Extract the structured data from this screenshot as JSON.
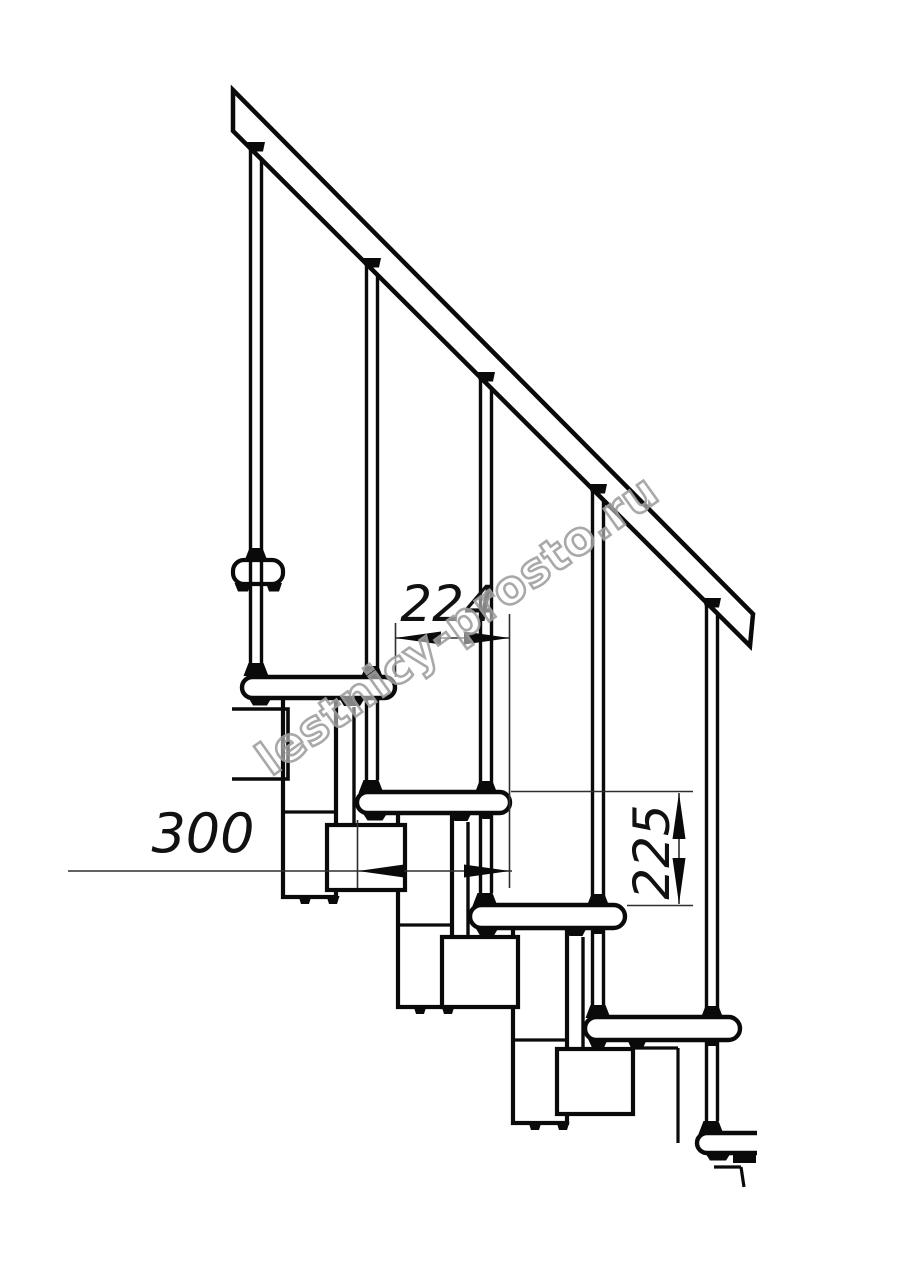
{
  "watermark": {
    "text": "lestnicy-prosto.ru",
    "fill": "#ffffff",
    "outline_color": "#a0a0a0",
    "angle_deg": -35.5,
    "font_size": 46
  },
  "dimensions": {
    "going": {
      "label": "224"
    },
    "tread_depth": {
      "label": "300"
    },
    "rise": {
      "label": "225"
    }
  },
  "drawing": {
    "line_color": "#0a0a0a",
    "thin_color": "#2e2e2e",
    "bg_color": "#ffffff",
    "stroke": {
      "thick": 4.5,
      "rod": 3.4,
      "mid": 3.2,
      "thin": 1.6
    },
    "rail": {
      "points": [
        [
          233,
          90
        ],
        [
          753,
          614
        ],
        [
          750,
          646
        ],
        [
          233,
          131
        ]
      ]
    },
    "bracket": {
      "x": 233,
      "y": 560,
      "w": 50,
      "h": 24,
      "r": 11
    },
    "landing": {
      "points": [
        [
          232,
          709
        ],
        [
          288,
          709
        ],
        [
          288,
          779
        ],
        [
          232,
          779
        ]
      ]
    },
    "balusters": [
      {
        "cx": 256,
        "top": 151,
        "bottom": 663
      },
      {
        "cx": 372,
        "top": 267,
        "bottom": 780
      },
      {
        "cx": 486,
        "top": 381,
        "bottom": 893
      },
      {
        "cx": 598,
        "top": 493,
        "bottom": 1005
      },
      {
        "cx": 712,
        "top": 607,
        "bottom": 1121
      }
    ],
    "rod_half_gap": 5.5,
    "treads": [
      {
        "x": 242,
        "y": 677,
        "w": 153,
        "h": 21
      },
      {
        "x": 357,
        "y": 792,
        "w": 153,
        "h": 21
      },
      {
        "x": 470,
        "y": 905,
        "w": 155,
        "h": 23
      },
      {
        "x": 585,
        "y": 1017,
        "w": 155,
        "h": 23
      }
    ],
    "cut_step": {
      "x": 697,
      "y": 1133,
      "w": 60,
      "h": 20
    },
    "blocks": [
      {
        "x": 283,
        "y": 697,
        "w": 53,
        "h": 200,
        "joint": 812
      },
      {
        "x": 398,
        "y": 812,
        "w": 54,
        "h": 195,
        "joint": 925
      },
      {
        "x": 513,
        "y": 928,
        "w": 54,
        "h": 195,
        "joint": 1040
      }
    ],
    "squares": [
      {
        "x": 327,
        "y": 825,
        "w": 78,
        "h": 65
      },
      {
        "x": 442,
        "y": 937,
        "w": 76,
        "h": 70
      },
      {
        "x": 557,
        "y": 1049,
        "w": 76,
        "h": 65
      }
    ],
    "extra_lines": [
      [
        354,
        707,
        354,
        825
      ],
      [
        468,
        822,
        468,
        937
      ],
      [
        583,
        937,
        583,
        1049
      ]
    ],
    "cut_lines": [
      [
        633,
        1048,
        678,
        1048
      ],
      [
        678,
        1048,
        678,
        1143
      ],
      [
        714,
        1167,
        741,
        1167
      ],
      [
        741,
        1167,
        744,
        1187
      ]
    ],
    "black_rects": [
      {
        "x": 733,
        "y": 1154,
        "w": 23,
        "h": 9
      }
    ],
    "trapezoids": [
      {
        "cx": 256,
        "y": 142,
        "h": 9.5,
        "wt": 18,
        "wb": 14
      },
      {
        "cx": 372,
        "y": 258,
        "h": 9.5,
        "wt": 18,
        "wb": 14
      },
      {
        "cx": 486,
        "y": 372,
        "h": 9.5,
        "wt": 18,
        "wb": 14
      },
      {
        "cx": 598,
        "y": 484,
        "h": 9.5,
        "wt": 18,
        "wb": 14
      },
      {
        "cx": 712,
        "y": 598,
        "h": 9.5,
        "wt": 18,
        "wb": 14
      },
      {
        "cx": 256,
        "y": 663,
        "h": 13,
        "wt": 15,
        "wb": 25
      },
      {
        "cx": 371,
        "y": 780,
        "h": 13,
        "wt": 15,
        "wb": 25
      },
      {
        "cx": 485,
        "y": 893,
        "h": 13,
        "wt": 15,
        "wb": 25
      },
      {
        "cx": 598,
        "y": 1005,
        "h": 13,
        "wt": 15,
        "wb": 25
      },
      {
        "cx": 711,
        "y": 1121,
        "h": 13,
        "wt": 15,
        "wb": 25
      },
      {
        "cx": 256,
        "y": 548,
        "h": 11.5,
        "wt": 13,
        "wb": 22
      },
      {
        "cx": 372,
        "y": 666,
        "h": 11.5,
        "wt": 13,
        "wb": 22
      },
      {
        "cx": 486,
        "y": 781,
        "h": 11.5,
        "wt": 13,
        "wb": 22
      },
      {
        "cx": 598,
        "y": 894,
        "h": 11.5,
        "wt": 13,
        "wb": 22
      },
      {
        "cx": 712,
        "y": 1006,
        "h": 11.5,
        "wt": 13,
        "wb": 22
      },
      {
        "cx": 243,
        "y": 583,
        "h": 8.5,
        "wt": 17,
        "wb": 10
      },
      {
        "cx": 274,
        "y": 583,
        "h": 8.5,
        "wt": 16,
        "wb": 10
      },
      {
        "cx": 260,
        "y": 697,
        "h": 8.5,
        "wt": 24,
        "wb": 14
      },
      {
        "cx": 352,
        "y": 697,
        "h": 9,
        "wt": 27,
        "wb": 16
      },
      {
        "cx": 375,
        "y": 812,
        "h": 8.5,
        "wt": 26,
        "wb": 15
      },
      {
        "cx": 461,
        "y": 812,
        "h": 9,
        "wt": 22,
        "wb": 13
      },
      {
        "cx": 487,
        "y": 812,
        "h": 7,
        "wt": 14,
        "wb": 9
      },
      {
        "cx": 487,
        "y": 927,
        "h": 8.5,
        "wt": 24,
        "wb": 14
      },
      {
        "cx": 576,
        "y": 927,
        "h": 9,
        "wt": 22,
        "wb": 13
      },
      {
        "cx": 598,
        "y": 927,
        "h": 7,
        "wt": 14,
        "wb": 9
      },
      {
        "cx": 598,
        "y": 1039,
        "h": 8.5,
        "wt": 20,
        "wb": 12
      },
      {
        "cx": 637,
        "y": 1039,
        "h": 9,
        "wt": 20,
        "wb": 12
      },
      {
        "cx": 712,
        "y": 1039,
        "h": 7,
        "wt": 14,
        "wb": 9
      },
      {
        "cx": 718,
        "y": 1152,
        "h": 8.5,
        "wt": 27,
        "wb": 16
      },
      {
        "cx": 305,
        "y": 896,
        "h": 8,
        "wt": 13,
        "wb": 8
      },
      {
        "cx": 333,
        "y": 896,
        "h": 8,
        "wt": 13,
        "wb": 8
      },
      {
        "cx": 420,
        "y": 1006,
        "h": 8,
        "wt": 13,
        "wb": 8
      },
      {
        "cx": 448,
        "y": 1006,
        "h": 8,
        "wt": 13,
        "wb": 8
      },
      {
        "cx": 535,
        "y": 1122,
        "h": 8,
        "wt": 13,
        "wb": 8
      },
      {
        "cx": 563,
        "y": 1122,
        "h": 8,
        "wt": 13,
        "wb": 8
      }
    ],
    "ext_lines": [
      [
        395.5,
        623,
        395.5,
        677
      ],
      [
        509.5,
        614,
        509.5,
        888
      ],
      [
        357.5,
        820,
        357.5,
        888
      ],
      [
        511,
        791.5,
        693,
        791.5
      ],
      [
        627,
        905.5,
        693,
        905.5
      ]
    ],
    "dim_lines": [
      [
        395,
        638,
        510,
        638
      ],
      [
        68,
        871,
        512,
        871
      ],
      [
        679,
        793,
        679,
        904
      ]
    ],
    "arrows": [
      {
        "x": 395,
        "y": 638,
        "d": "l"
      },
      {
        "x": 510,
        "y": 638,
        "d": "r"
      },
      {
        "x": 358,
        "y": 871,
        "d": "l"
      },
      {
        "x": 510,
        "y": 871,
        "d": "r"
      },
      {
        "x": 679,
        "y": 793,
        "d": "u"
      },
      {
        "x": 679,
        "y": 904,
        "d": "d"
      }
    ],
    "arrow_len": 46,
    "arrow_half": 6.5
  }
}
